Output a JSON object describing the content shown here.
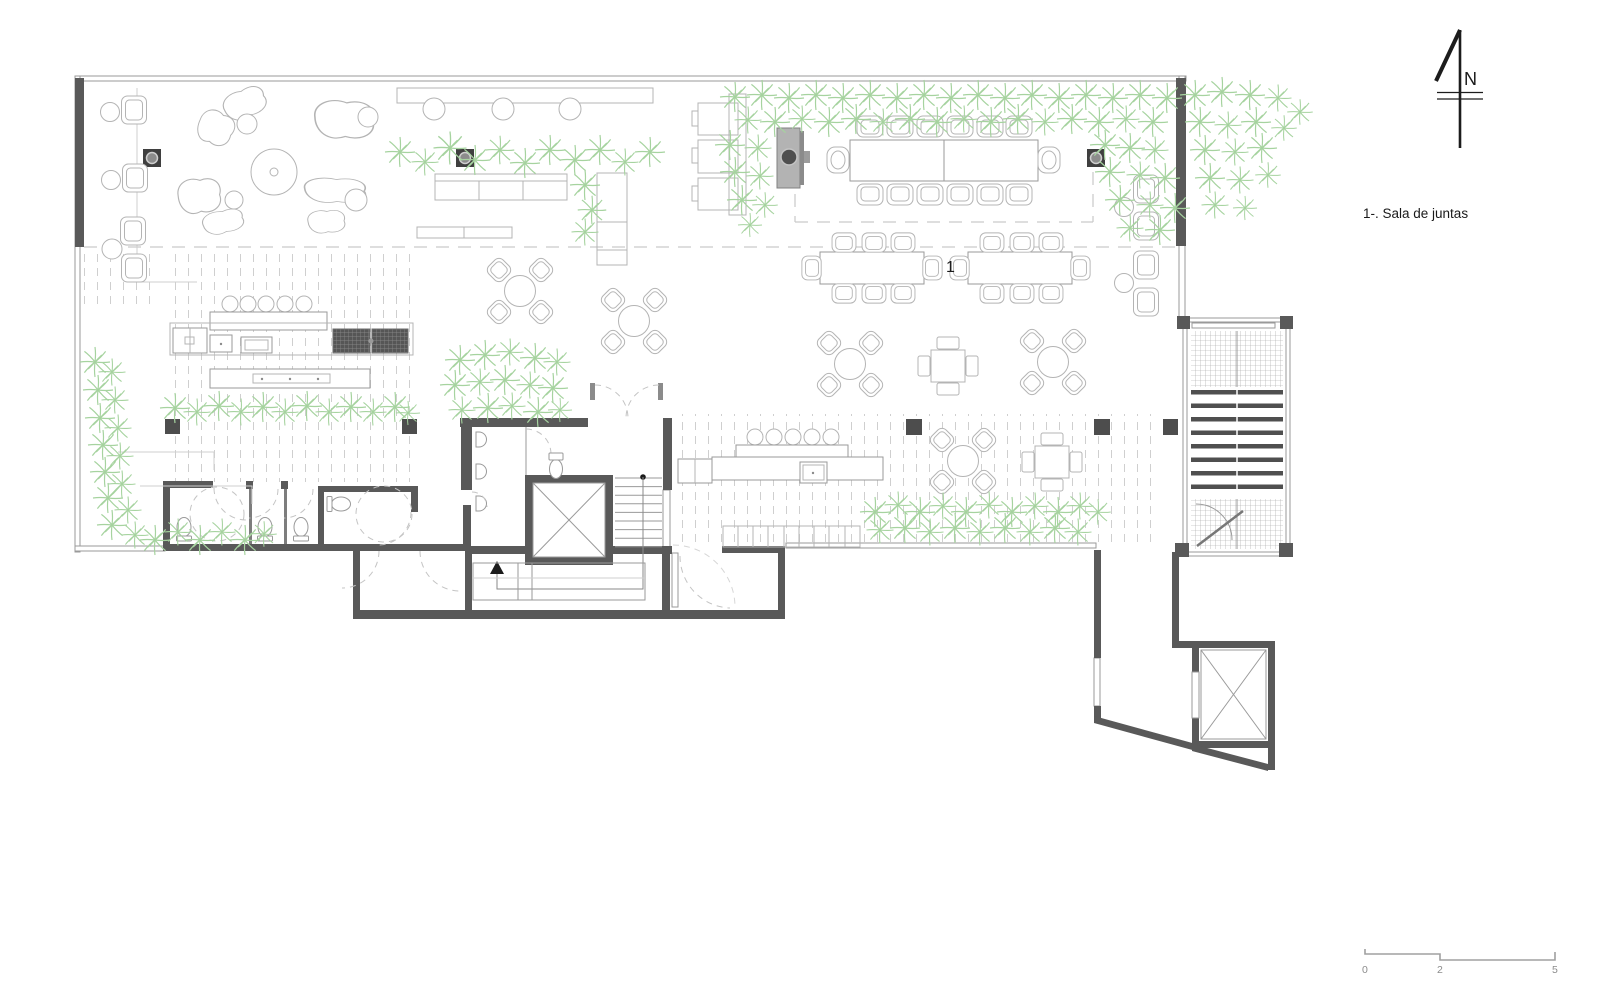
{
  "document": {
    "type": "architectural-floor-plan",
    "description": "Restaurant / office level floor plan with terraces, meeting room, bars, restrooms, stairs and elevators"
  },
  "annotations": {
    "room_number": "1"
  },
  "legend": {
    "items": [
      {
        "text": "1-. Sala de juntas"
      }
    ]
  },
  "north_arrow": {
    "label": "N"
  },
  "scale_bar": {
    "ticks": [
      "0",
      "2",
      "5"
    ]
  },
  "colors": {
    "wall_dark": "#595959",
    "thin_line": "#9a9a9a",
    "furniture_line": "#b4b4b4",
    "plant_green": "#a6d39f",
    "deck_dash": "#cfcfcf",
    "label_text": "#1a1a1a",
    "scale_gray": "#8c8c8c"
  },
  "icons": {
    "north": "north-arrow-icon",
    "elevator": "elevator-x-icon",
    "stair": "stairs-icon",
    "toilet": "toilet-icon",
    "plant": "palm-plant-icon",
    "column": "column-icon"
  }
}
